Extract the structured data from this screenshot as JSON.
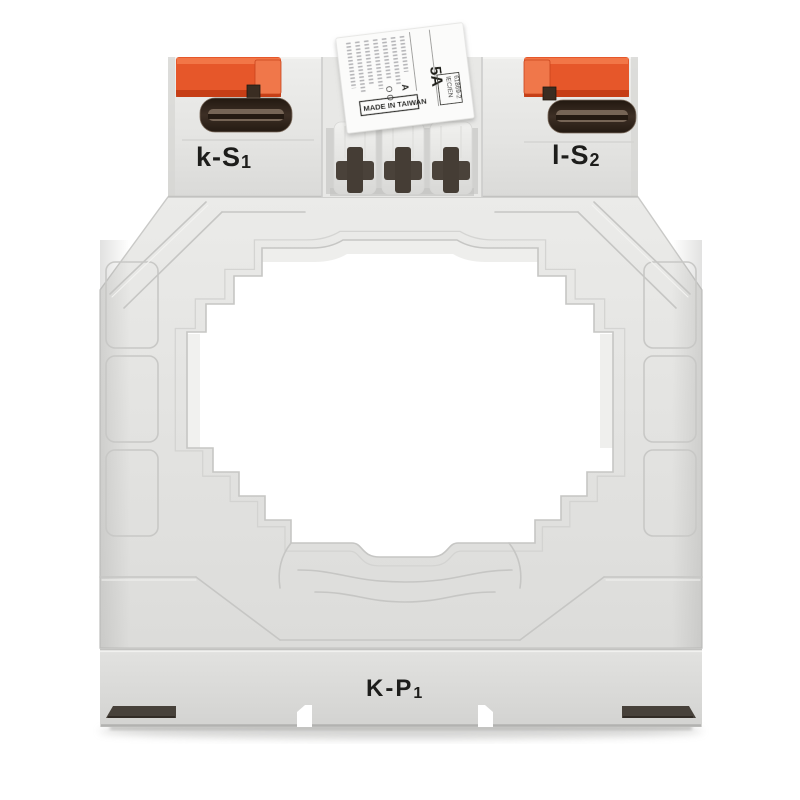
{
  "meta": {
    "description": "Front product photograph of a gray DIN-mount current transformer with orange terminal covers and a stepped square window",
    "background": "#ffffff"
  },
  "device": {
    "markings": {
      "secondary_terminal_left": {
        "text": "k-S",
        "sub": "1"
      },
      "secondary_terminal_right": {
        "text": "l-S",
        "sub": "2"
      },
      "primary_marking_bottom": {
        "text": "K-P",
        "sub": "1"
      },
      "sticker": {
        "rating": "5A",
        "marks_o": "O O",
        "marks_a": "A",
        "made_in": "MADE IN TAIWAN",
        "standard_line1": "IEC/EN",
        "standard_line2": "61869-2"
      }
    },
    "colors": {
      "body": "#e4e4e2",
      "body_dark": "#d7d7d5",
      "panel_line": "#c6c6c4",
      "cap_orange": "#e6572a",
      "cap_orange_dark": "#c23c14",
      "cap_orange_light": "#f0774a",
      "slot_dark": "#33271e",
      "screw_metal": "#8d7a6a",
      "cross_hole": "#4a423a",
      "din_slot": "#47413a",
      "sticker_bg": "#fbfbfa",
      "text": "#1d1d1b",
      "hole": "#ffffff",
      "shadow": "#c4c4c2"
    }
  }
}
